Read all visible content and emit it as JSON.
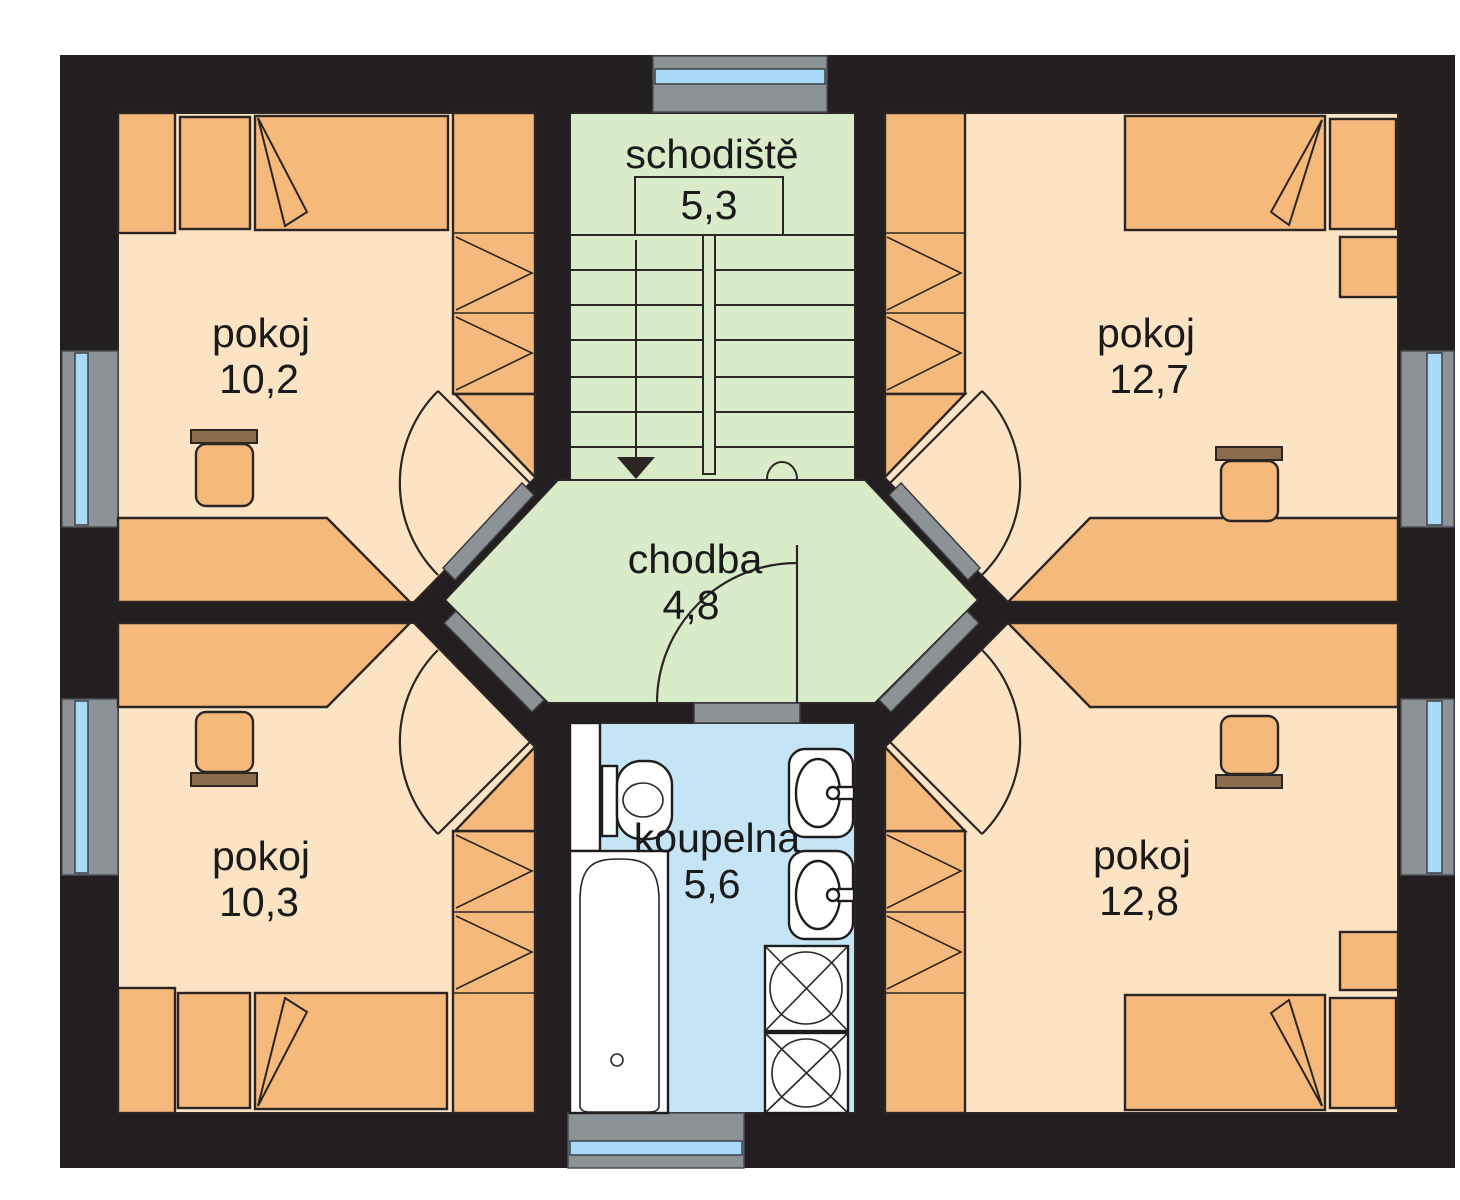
{
  "plan": {
    "type": "floor-plan",
    "rooms": [
      {
        "id": "pokoj-top-left",
        "label": "pokoj",
        "area": "10,2"
      },
      {
        "id": "schodiste",
        "label": "schodiště",
        "area": "5,3"
      },
      {
        "id": "pokoj-top-right",
        "label": "pokoj",
        "area": "12,7"
      },
      {
        "id": "chodba",
        "label": "chodba",
        "area": "4,8"
      },
      {
        "id": "pokoj-bottom-left",
        "label": "pokoj",
        "area": "10,3"
      },
      {
        "id": "koupelna",
        "label": "koupelna",
        "area": "5,6"
      },
      {
        "id": "pokoj-bottom-right",
        "label": "pokoj",
        "area": "12,8"
      }
    ],
    "colors": {
      "wall": "#231f20",
      "room_fill": "#fbe3c3",
      "furniture_fill": "#f5b97c",
      "circulation_fill": "#d9ecca",
      "bathroom_fill": "#c5e4f6",
      "fixture_fill": "#ffffff",
      "window_glass": "#a8d9f8",
      "window_frame": "#8d9297",
      "door_threshold": "#8d9297",
      "line": "#2b2523",
      "text": "#1a1a1a"
    }
  }
}
